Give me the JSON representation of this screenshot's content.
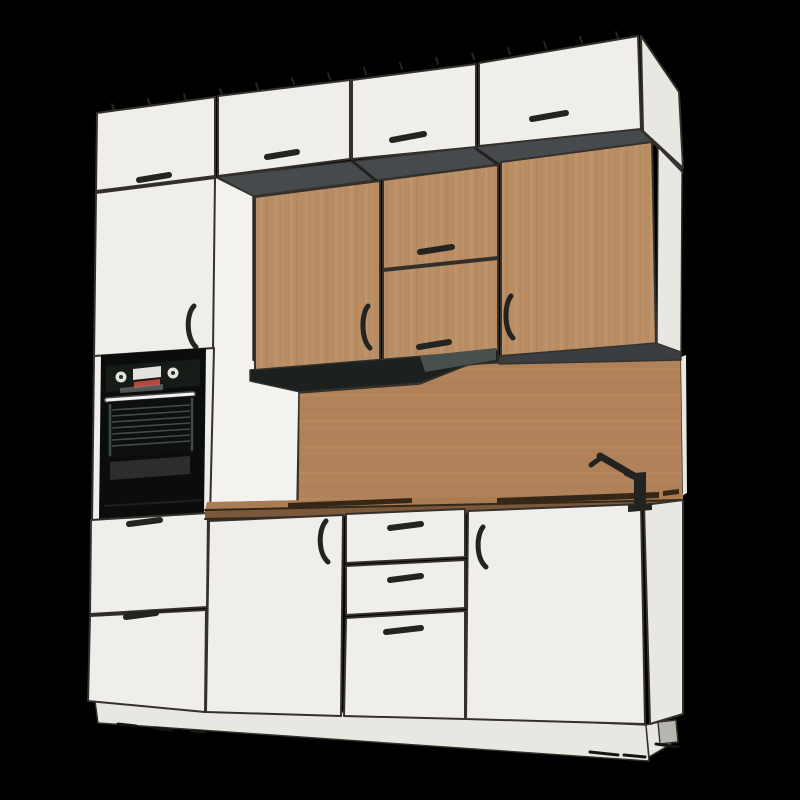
{
  "scene": {
    "name": "kitchen-cabinet-3d-render",
    "description": "Sketch-style perspective render of a kitchenette on a black background"
  },
  "palette": {
    "bg": "#000000",
    "outline": "#34312c",
    "door_white": "#efeeea",
    "door_side_white": "#e9e7e1",
    "filler_white": "#f3f2ee",
    "soffit": "#474a4d",
    "soffit_dark": "#3a3e41",
    "wood": "#b88d64",
    "wood_light": "#c89b70",
    "wood_dark": "#a67c55",
    "backsplash": "#b18159",
    "backsplash_light": "#bd8d63",
    "counter_top": "#ab7c52",
    "counter_edge": "#7c583a",
    "counter_dark": "#342718",
    "hood": "#1c201e",
    "hood_panel": "#47504c",
    "niche": "#0a0d0b",
    "oven_panel": "#171b18",
    "oven_glass": "#0d100e",
    "oven_highlight": "#f2f3ee",
    "oven_rack": "#555a53",
    "oven_glow": "#7d9083",
    "oven_display": "#e3e3dd",
    "oven_led": "#b5483e",
    "handle": "#232321",
    "plinth": "#e8e7e2",
    "foot": "#b6b5b0",
    "shadow_dash": "#141412"
  },
  "objects": [
    "top box row with four white doors",
    "tall housing cabinet with built-in oven and two drawers",
    "wood wall cabinet hinged door left",
    "wood wall cabinet with two lift-up flaps",
    "wood wall cabinet hinged door right",
    "under-cabinet extractor hood",
    "wood backsplash panel",
    "wood worktop with hob and sink cutouts",
    "single-lever faucet",
    "base cabinet door left",
    "base unit with three drawers",
    "base cabinet door right",
    "plinth with adjustable foot"
  ]
}
